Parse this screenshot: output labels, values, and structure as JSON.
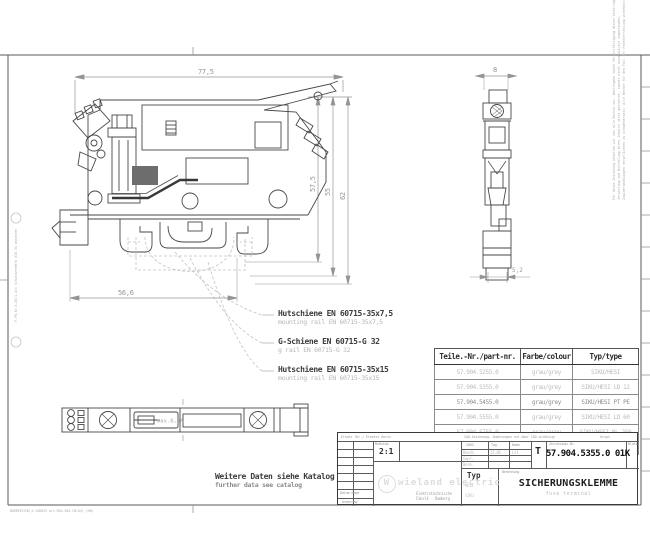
{
  "frame": {
    "file_note": "NORMZEICHN_a CAD035  art.KDA-500-CB(A4)  (HB)",
    "left_note": "F-PN-Nr-4-05/1-alt  Schutzvermerk DIN 34 beachten",
    "right_notice_1": "Für diese Zeichnung behalten wir uns alle Rechte vor. Weitergabe sowie Vervielfältigung dieser Unterlage,",
    "right_notice_2": "Verwertung und Mitteilung ihres Inhalts nicht gestattet, soweit nicht ausdrücklich zugestanden.",
    "right_notice_3": "Zuwiderhandlungen verpflichten zu Schadenersatz. Alle Rechte für den Fall der Patenterteilung vorbehalten."
  },
  "main_view": {
    "dim_width": "77,5",
    "dim_h1": "57,5",
    "dim_h2": "55",
    "dim_h3": "62",
    "dim_base": "56,6"
  },
  "front_view": {
    "dim_width": "8",
    "dim_foot": "5,2"
  },
  "top_view": {
    "fuse_note": "max.6,3A"
  },
  "rail_labels": [
    {
      "de": "Hutschiene EN 60715-35x7,5",
      "en": "mounting rail EN 60715-35x7,5"
    },
    {
      "de": "G-Schiene EN 60715-G 32",
      "en": "g rail EN 60715-G 32"
    },
    {
      "de": "Hutschiene EN 60715-35x15",
      "en": "mounting rail EN 60715-35x15"
    }
  ],
  "catalog_note": {
    "de": "Weitere Daten siehe Katalog",
    "en": "further data see catalog"
  },
  "parts_table": {
    "headers": [
      "Teile.-Nr./part-nr.",
      "Farbe/colour",
      "Typ/type"
    ],
    "rows": [
      {
        "part": "57.904.5255.0",
        "colour": "grau/grey",
        "type": "SIKU/HESI"
      },
      {
        "part": "57.904.5355.0",
        "colour": "grau/grey",
        "type": "SIKU/HESI LD 12"
      },
      {
        "part": "57.904.5455.0",
        "colour": "grau/grey",
        "type": "SIKU/HESI PT PE"
      },
      {
        "part": "57.904.5555.0",
        "colour": "grau/grey",
        "type": "SIKU/HESI LD 60"
      },
      {
        "part": "57.904.5755.0",
        "colour": "grau/grey",
        "type": "SIKU/HESI NL 250"
      },
      {
        "part": "57.904.5855.0",
        "colour": "grau/grey",
        "type": "SIKU/HESI NL GR"
      }
    ]
  },
  "title_block": {
    "strip_left": "Ersatz für / Ersetzt durch",
    "strip_mid": "CAD-Zeichnung. Änderungen nur über CAD zulässig!",
    "strip_right": "Urspr.",
    "scale_label": "Maßstab",
    "scale": "2:1",
    "company": "wieland electric",
    "company_sub1": "Elektrotechnische",
    "company_sub2": "Fabrik · Bamberg",
    "year": "2003",
    "tag_label": "Tag",
    "name_label": "Name",
    "sign_rows": [
      {
        "label": "Bearb.",
        "tag": "12.06",
        "name": "Lst"
      },
      {
        "label": "Gepr.",
        "tag": "",
        "name": ""
      },
      {
        "label": "Norm.",
        "tag": "",
        "name": ""
      }
    ],
    "t_label": "T",
    "drawing_no_label": "Zeichnungs-Nr.",
    "drawing_no": "57.904.5355.0 01K",
    "blatt_label": "Blatt",
    "typ_label": "Typ",
    "typ_line1": "HESI",
    "typ_line2": "SIKU",
    "benennung_label": "Benennung",
    "title": "SICHERUNGSKLEMME",
    "subtitle": "fuse terminal",
    "rev_footer_1": "Datum Name",
    "rev_footer_2": "Änderung"
  }
}
